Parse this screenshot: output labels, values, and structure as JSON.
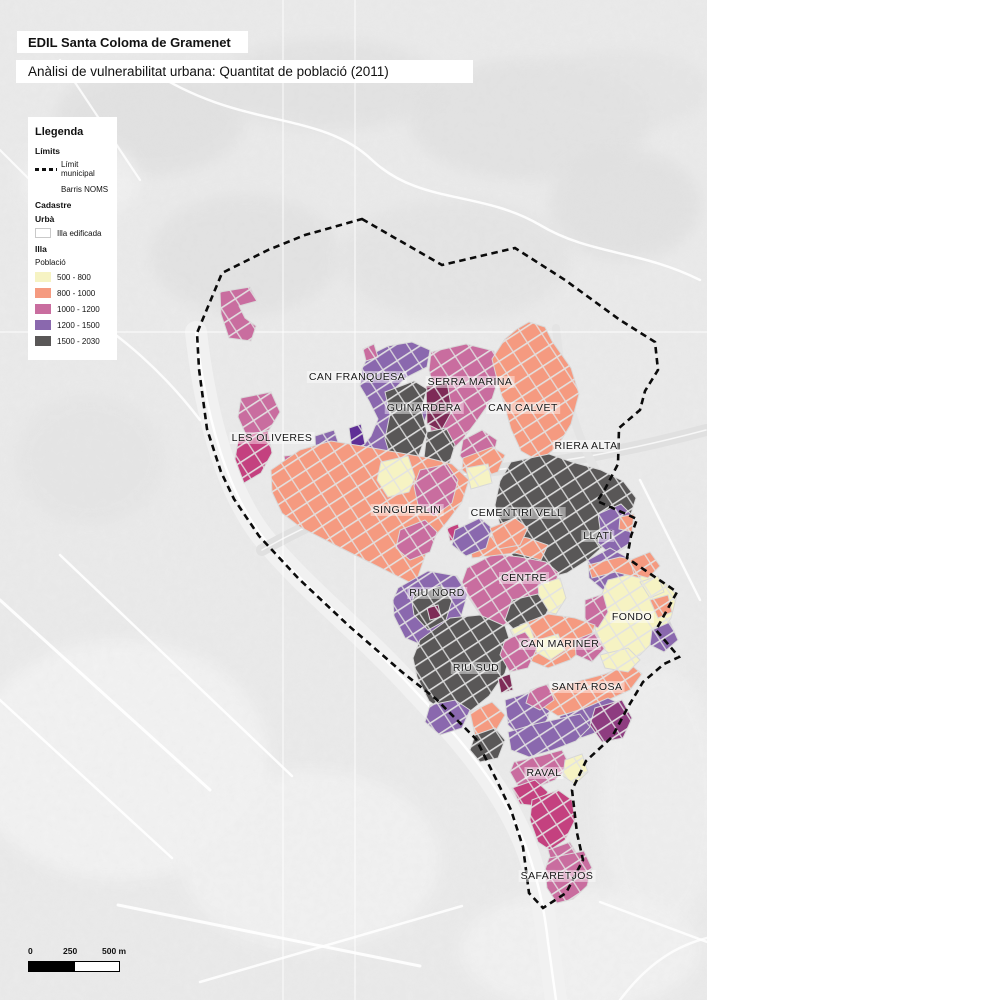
{
  "header": {
    "title": "EDIL Santa Coloma de Gramenet",
    "subtitle": "Anàlisi de vulnerabilitat urbana: Quantitat de població (2011)"
  },
  "legend": {
    "title": "Llegenda",
    "limits_heading": "Límits",
    "limit_municipal_label": "Límit municipal",
    "barris_label": "Barris NOMS",
    "cadastre_heading_line1": "Cadastre",
    "cadastre_heading_line2": "Urbà",
    "illa_edificada_label": "Illa edificada",
    "illa_heading": "Illa",
    "poblacio_label": "Població",
    "population_classes": [
      {
        "label": "500 - 800",
        "color": "#f6f3c3"
      },
      {
        "label": "800 - 1000",
        "color": "#f59a80"
      },
      {
        "label": "1000 - 1200",
        "color": "#c96d9f"
      },
      {
        "label": "1200 - 1500",
        "color": "#8a68ae"
      },
      {
        "label": "1500 - 2030",
        "color": "#595757"
      }
    ]
  },
  "scale_bar": {
    "labels": [
      "0",
      "250",
      "500 m"
    ]
  },
  "map": {
    "colors": {
      "y": "#f6f3c3",
      "s": "#f59a80",
      "p": "#c96d9f",
      "v": "#8a68ae",
      "g": "#595757",
      "m": "#7e2b57",
      "r": "#c4417f",
      "d": "#8e3c80",
      "vd": "#5f2f96"
    },
    "graticule": {
      "verticals": [
        283,
        355
      ],
      "horizontals": [
        332
      ],
      "color": "#ffffff"
    },
    "hills": [
      [
        150,
        120,
        95,
        55,
        "#e0e0e0",
        0.8
      ],
      [
        330,
        85,
        115,
        45,
        "#e1e1e1",
        0.8
      ],
      [
        530,
        120,
        120,
        60,
        "#dfdfdf",
        0.7
      ],
      [
        245,
        255,
        95,
        60,
        "#e0e0e0",
        0.7
      ],
      [
        455,
        260,
        115,
        60,
        "#e2e2e2",
        0.7
      ],
      [
        625,
        205,
        75,
        55,
        "#dedede",
        0.7
      ],
      [
        90,
        460,
        75,
        65,
        "#e3e3e3",
        0.6
      ],
      [
        620,
        90,
        90,
        40,
        "#e3e3e3",
        0.7
      ],
      [
        120,
        760,
        150,
        120,
        "#f3f3f3",
        0.9
      ],
      [
        310,
        860,
        130,
        90,
        "#f2f2f2",
        0.9
      ],
      [
        80,
        180,
        60,
        40,
        "#f2f2f2",
        0.8
      ],
      [
        660,
        800,
        60,
        130,
        "#f0f0f0",
        0.8
      ],
      [
        580,
        950,
        120,
        60,
        "#f2f2f2",
        0.9
      ]
    ],
    "roads": [
      [
        "M196,332 C206,420 228,492 262,536 C304,588 362,632 416,692 C462,740 506,792 528,852 C538,882 544,906 548,942 L556,1000",
        "#f1f1f1",
        22,
        1
      ],
      [
        "M196,332 C206,420 228,492 262,536 C304,588 362,632 416,692 C462,740 506,792 528,852 C538,882 544,906 548,942 L556,1000",
        "#ffffff",
        2.5,
        0.9
      ],
      [
        "M262,550 C340,506 420,480 480,472 C545,463 600,458 706,430",
        "#e0e0e0",
        12,
        1
      ],
      [
        "M262,550 C340,506 420,480 480,472 C545,463 600,458 706,430",
        "#f7f7f7",
        1.5,
        1
      ],
      [
        "M556,328 C562,386 576,436 596,470",
        "#e4e4e4",
        8,
        1
      ],
      [
        "M150,70 C240,130 320,110 372,160 C420,205 480,190 540,225 C590,255 640,250 700,280",
        "#ffffff",
        2.5,
        0.9
      ],
      [
        "M60,300 C120,330 168,378 200,420",
        "#ffffff",
        2.5,
        0.85
      ],
      [
        "M0,600 L210,790",
        "#ffffff",
        3,
        0.9
      ],
      [
        "M60,555 L292,776",
        "#ffffff",
        2.5,
        0.9
      ],
      [
        "M0,700 L172,858",
        "#ffffff",
        2.5,
        0.9
      ],
      [
        "M118,905 L420,966",
        "#ffffff",
        3,
        0.9
      ],
      [
        "M200,982 L462,906",
        "#ffffff",
        2.5,
        0.85
      ],
      [
        "M640,480 C660,520 680,560 700,600",
        "#ffffff",
        2.5,
        0.85
      ],
      [
        "M600,902 L707,942",
        "#ffffff",
        2.5,
        0.85
      ],
      [
        "M620,1000 C650,960 680,945 707,938",
        "#ffffff",
        2.5,
        0.8
      ],
      [
        "M60,60 L140,180",
        "#ffffff",
        2.2,
        0.8
      ],
      [
        "M0,150 L90,240",
        "#ffffff",
        2.2,
        0.8
      ]
    ],
    "patches": [
      {
        "c": "p",
        "pts": "220,292 250,287 257,301 239,306 245,318 256,326 251,341 229,338 221,314"
      },
      {
        "c": "p",
        "pts": "241,398 271,392 280,412 269,430 247,437 238,417"
      },
      {
        "c": "r",
        "pts": "239,436 268,431 272,453 261,473 244,483 235,459"
      },
      {
        "c": "p",
        "pts": "284,456 322,452 326,464 286,468"
      },
      {
        "c": "v",
        "pts": "315,436 334,430 340,448 330,460 316,456"
      },
      {
        "c": "v",
        "pts": "368,356 388,346 412,342 430,350 427,367 407,377 394,389 400,404 416,399 428,411 421,431 402,444 386,461 374,479 359,488 351,470 359,451 371,436 378,419 369,401 360,386 362,369"
      },
      {
        "c": "p",
        "pts": "363,349 374,344 378,357 366,361"
      },
      {
        "c": "vd",
        "pts": "349,428 361,424 365,444 352,450"
      },
      {
        "c": "v",
        "pts": "351,471 374,480 392,474 406,486 400,505 380,515 360,512 347,498 344,482"
      },
      {
        "c": "v",
        "pts": "416,498 436,492 446,502 440,520 420,526 410,512"
      },
      {
        "c": "p",
        "pts": "431,352 466,344 494,351 500,374 492,399 478,419 463,439 447,455 433,441 428,416 434,391 429,370"
      },
      {
        "c": "m",
        "pts": "426,386 447,382 452,411 441,431 427,424"
      },
      {
        "c": "p",
        "pts": "463,440 482,430 497,440 492,462 472,470 460,456"
      },
      {
        "c": "g",
        "pts": "385,392 414,381 427,389 421,410 427,432 419,455 427,477 414,494 397,500 388,484 392,461 385,439 390,414"
      },
      {
        "c": "g",
        "pts": "427,432 446,428 455,445 448,468 433,478 424,458"
      },
      {
        "c": "g",
        "pts": "393,500 410,495 420,503 415,518 399,524 388,514"
      },
      {
        "c": "s",
        "pts": "529,322 545,327 552,341 571,368 579,394 571,424 557,447 539,461 521,451 511,429 504,404 497,379 492,359 505,339 517,329"
      },
      {
        "c": "s",
        "pts": "463,458 492,447 505,455 498,472 474,480 462,470"
      },
      {
        "c": "g",
        "pts": "511,462 549,454 572,462 601,470 623,481 636,498 629,520 609,541 589,559 567,573 544,579 524,570 509,551 501,529 495,505 500,481"
      },
      {
        "c": "v",
        "pts": "598,514 621,504 634,517 629,545 612,556 598,543 600,528"
      },
      {
        "c": "v",
        "pts": "588,560 610,548 628,558 623,580 603,590 589,578"
      },
      {
        "c": "s",
        "pts": "620,517 634,514 632,532 619,529"
      },
      {
        "c": "s",
        "pts": "271,470 300,450 331,441 362,446 395,452 424,457 452,464 469,480 462,502 447,522 430,542 415,585 375,565 335,545 300,527 282,513 272,492"
      },
      {
        "c": "y",
        "pts": "381,462 408,456 415,477 409,492 388,497 377,480"
      },
      {
        "c": "y",
        "pts": "466,468 488,464 492,483 471,489"
      },
      {
        "c": "p",
        "pts": "420,470 447,464 458,480 452,503 434,516 418,505 414,486"
      },
      {
        "c": "p",
        "pts": "400,530 425,520 437,532 430,552 410,560 396,548"
      },
      {
        "c": "v",
        "pts": "398,588 428,571 457,576 468,593 461,617 444,636 424,646 405,638 394,616 393,600"
      },
      {
        "c": "g",
        "pts": "415,593 441,586 452,600 446,620 428,630 414,615 412,602"
      },
      {
        "c": "m",
        "pts": "427,608 438,605 441,617 430,620"
      },
      {
        "c": "r",
        "pts": "447,528 458,524 462,538 450,541"
      },
      {
        "c": "p",
        "pts": "467,568 494,554 520,557 546,562 559,573 551,593 537,609 519,623 499,626 481,616 469,598 462,582"
      },
      {
        "c": "y",
        "pts": "538,585 560,578 566,598 556,614 540,610"
      },
      {
        "c": "g",
        "pts": "512,600 538,594 548,610 539,628 518,634 505,620"
      },
      {
        "c": "s",
        "pts": "470,545 500,533 528,538 548,545 541,560 515,553 490,556 472,558"
      },
      {
        "c": "v",
        "pts": "455,530 480,518 492,528 486,548 466,556 452,545"
      },
      {
        "c": "s",
        "pts": "490,528 515,518 528,528 520,545 498,549"
      },
      {
        "c": "y",
        "pts": "608,580 640,572 662,580 677,595 671,618 657,638 640,655 620,662 605,650 595,629 598,604 604,589"
      },
      {
        "c": "s",
        "pts": "588,565 620,557 645,562 640,578 615,572 592,578"
      },
      {
        "c": "p",
        "pts": "585,600 603,594 608,612 598,628 585,622"
      },
      {
        "c": "s",
        "pts": "650,600 668,595 672,612 658,618"
      },
      {
        "c": "v",
        "pts": "652,630 670,622 678,640 664,652 650,645"
      },
      {
        "c": "s",
        "pts": "520,625 548,614 575,618 595,625 588,645 570,660 548,668 528,660 515,645"
      },
      {
        "c": "y",
        "pts": "538,640 558,634 565,650 550,660 536,652"
      },
      {
        "c": "p",
        "pts": "575,640 595,632 605,648 592,662 576,655"
      },
      {
        "c": "y",
        "pts": "510,630 528,622 534,638 518,645"
      },
      {
        "c": "g",
        "pts": "420,640 450,618 480,615 505,626 512,648 505,673 489,696 469,712 447,714 429,701 417,677 413,658"
      },
      {
        "c": "p",
        "pts": "505,640 525,632 537,648 528,668 510,672 500,655"
      },
      {
        "c": "m",
        "pts": "498,678 510,674 513,690 501,693"
      },
      {
        "c": "v",
        "pts": "430,705 455,700 470,710 462,728 440,735 425,722"
      },
      {
        "c": "s",
        "pts": "470,712 492,702 505,715 495,732 475,735"
      },
      {
        "c": "v",
        "pts": "505,700 530,692 552,698 548,718 540,730 520,736 508,725"
      },
      {
        "c": "g",
        "pts": "475,735 495,728 505,740 498,758 480,762 470,750"
      },
      {
        "c": "s",
        "pts": "545,690 575,682 605,674 630,664 642,674 630,690 608,700 582,710 558,716 542,706"
      },
      {
        "c": "y",
        "pts": "600,655 628,648 640,660 628,672 605,668"
      },
      {
        "c": "v",
        "pts": "560,716 585,708 608,698 625,706 618,722 598,732 575,740 558,732"
      },
      {
        "c": "d",
        "pts": "595,708 622,700 632,718 623,738 602,742 590,725"
      },
      {
        "c": "p",
        "pts": "530,690 548,684 554,700 540,710 526,703"
      },
      {
        "c": "v",
        "pts": "508,732 535,724 558,719 580,714 590,727 576,741 553,750 529,757 511,750"
      },
      {
        "c": "p",
        "pts": "514,762 540,756 562,750 570,766 555,780 535,788 518,786 510,772"
      },
      {
        "c": "r",
        "pts": "512,788 535,780 548,792 538,806 520,804"
      },
      {
        "c": "y",
        "pts": "565,760 582,754 588,772 575,784 563,776"
      },
      {
        "c": "r",
        "pts": "532,800 558,790 572,800 575,820 565,840 550,850 538,842 530,820"
      },
      {
        "c": "p",
        "pts": "548,850 570,842 578,856 568,868 552,864"
      },
      {
        "c": "p",
        "pts": "549,858 584,851 592,868 587,886 573,899 557,903 547,888 545,870"
      },
      {
        "c": "s",
        "pts": "630,560 650,552 660,566 648,578 634,574"
      },
      {
        "c": "y",
        "pts": "640,582 658,576 664,592 650,598"
      }
    ],
    "boundary": [
      [
        362,
        219
      ],
      [
        442,
        265
      ],
      [
        515,
        248
      ],
      [
        565,
        280
      ],
      [
        620,
        320
      ],
      [
        655,
        342
      ],
      [
        658,
        370
      ],
      [
        645,
        391
      ],
      [
        640,
        410
      ],
      [
        619,
        428
      ],
      [
        618,
        464
      ],
      [
        604,
        491
      ],
      [
        597,
        501
      ],
      [
        637,
        519
      ],
      [
        631,
        536
      ],
      [
        627,
        558
      ],
      [
        677,
        592
      ],
      [
        656,
        630
      ],
      [
        679,
        657
      ],
      [
        664,
        664
      ],
      [
        643,
        682
      ],
      [
        628,
        707
      ],
      [
        612,
        737
      ],
      [
        586,
        761
      ],
      [
        572,
        790
      ],
      [
        577,
        833
      ],
      [
        583,
        860
      ],
      [
        566,
        893
      ],
      [
        543,
        908
      ],
      [
        529,
        893
      ],
      [
        523,
        847
      ],
      [
        511,
        810
      ],
      [
        496,
        779
      ],
      [
        476,
        739
      ],
      [
        436,
        699
      ],
      [
        402,
        672
      ],
      [
        349,
        626
      ],
      [
        299,
        579
      ],
      [
        259,
        536
      ],
      [
        234,
        499
      ],
      [
        221,
        472
      ],
      [
        207,
        429
      ],
      [
        199,
        369
      ],
      [
        197,
        333
      ],
      [
        222,
        273
      ],
      [
        268,
        250
      ],
      [
        305,
        235
      ]
    ],
    "labels": [
      {
        "text": "CAN FRANQUESA",
        "x": 357,
        "y": 377
      },
      {
        "text": "SERRA MARINA",
        "x": 470,
        "y": 382
      },
      {
        "text": "GUINARDERA",
        "x": 424,
        "y": 408
      },
      {
        "text": "CAN CALVET",
        "x": 523,
        "y": 408
      },
      {
        "text": "LES OLIVERES",
        "x": 272,
        "y": 438
      },
      {
        "text": "RIERA ALTA",
        "x": 586,
        "y": 446
      },
      {
        "text": "SINGUERLIN",
        "x": 407,
        "y": 510
      },
      {
        "text": "CEMENTIRI VELL",
        "x": 517,
        "y": 513
      },
      {
        "text": "LLATÍ",
        "x": 598,
        "y": 536
      },
      {
        "text": "CENTRE",
        "x": 524,
        "y": 578
      },
      {
        "text": "RIU NORD",
        "x": 437,
        "y": 593
      },
      {
        "text": "FONDO",
        "x": 632,
        "y": 617
      },
      {
        "text": "CAN MARINER",
        "x": 560,
        "y": 644
      },
      {
        "text": "RIU SUD",
        "x": 476,
        "y": 668
      },
      {
        "text": "SANTA ROSA",
        "x": 587,
        "y": 687
      },
      {
        "text": "RAVAL",
        "x": 544,
        "y": 773
      },
      {
        "text": "SAFARETJOS",
        "x": 557,
        "y": 876
      }
    ]
  }
}
